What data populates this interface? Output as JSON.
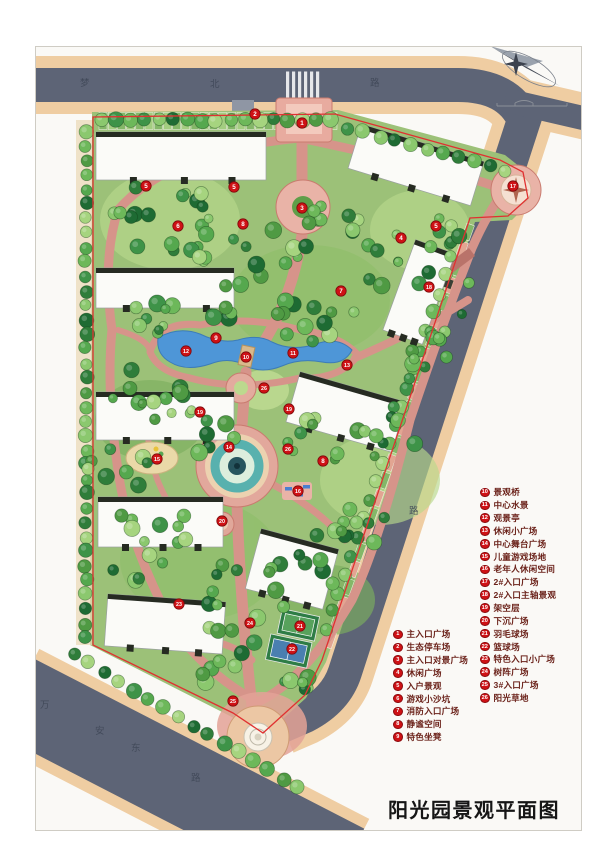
{
  "title": {
    "text": "阳光园景观平面图"
  },
  "legend": {
    "col1": [
      {
        "n": "1",
        "label": "主入口广场"
      },
      {
        "n": "2",
        "label": "生态停车场"
      },
      {
        "n": "3",
        "label": "主入口对景广场"
      },
      {
        "n": "4",
        "label": "休闲广场"
      },
      {
        "n": "5",
        "label": "入户景观"
      },
      {
        "n": "6",
        "label": "游戏小沙坑"
      },
      {
        "n": "7",
        "label": "消防入口广场"
      },
      {
        "n": "8",
        "label": "静谧空间"
      },
      {
        "n": "9",
        "label": "特色坐凳"
      }
    ],
    "col2": [
      {
        "n": "10",
        "label": "景观桥"
      },
      {
        "n": "11",
        "label": "中心水景"
      },
      {
        "n": "12",
        "label": "观景亭"
      },
      {
        "n": "13",
        "label": "休闲小广场"
      },
      {
        "n": "14",
        "label": "中心舞台广场"
      },
      {
        "n": "15",
        "label": "儿童游戏场地"
      },
      {
        "n": "16",
        "label": "老年人休闲空间"
      },
      {
        "n": "17",
        "label": "2#入口广场"
      },
      {
        "n": "18",
        "label": "2#入口主轴景观"
      },
      {
        "n": "19",
        "label": "架空层"
      },
      {
        "n": "20",
        "label": "下沉广场"
      },
      {
        "n": "21",
        "label": "羽毛球场"
      },
      {
        "n": "22",
        "label": "篮球场"
      },
      {
        "n": "23",
        "label": "特色入口小广场"
      },
      {
        "n": "24",
        "label": "树阵广场"
      },
      {
        "n": "25",
        "label": "3#入口广场"
      },
      {
        "n": "26",
        "label": "阳光草地"
      }
    ]
  },
  "roads": {
    "top": {
      "name": "梦北路",
      "chars": [
        {
          "ch": "梦",
          "x": 80,
          "y": 86
        },
        {
          "ch": "北",
          "x": 210,
          "y": 87
        },
        {
          "ch": "路",
          "x": 370,
          "y": 86
        }
      ]
    },
    "east": {
      "name": "路",
      "chars": [
        {
          "ch": "路",
          "x": 409,
          "y": 514
        }
      ]
    },
    "southwest": {
      "name": "万安东路",
      "chars": [
        {
          "ch": "万",
          "x": 40,
          "y": 708
        },
        {
          "ch": "安",
          "x": 95,
          "y": 734
        },
        {
          "ch": "东",
          "x": 131,
          "y": 751
        },
        {
          "ch": "路",
          "x": 191,
          "y": 781
        }
      ]
    }
  },
  "markers": [
    {
      "n": "1",
      "x": 302,
      "y": 123
    },
    {
      "n": "2",
      "x": 255,
      "y": 114
    },
    {
      "n": "3",
      "x": 302,
      "y": 208
    },
    {
      "n": "5",
      "x": 146,
      "y": 186
    },
    {
      "n": "5",
      "x": 234,
      "y": 187
    },
    {
      "n": "6",
      "x": 178,
      "y": 226
    },
    {
      "n": "8",
      "x": 243,
      "y": 224
    },
    {
      "n": "4",
      "x": 401,
      "y": 238
    },
    {
      "n": "5",
      "x": 436,
      "y": 226
    },
    {
      "n": "7",
      "x": 341,
      "y": 291
    },
    {
      "n": "9",
      "x": 216,
      "y": 338
    },
    {
      "n": "12",
      "x": 186,
      "y": 351
    },
    {
      "n": "10",
      "x": 246,
      "y": 357
    },
    {
      "n": "11",
      "x": 293,
      "y": 353
    },
    {
      "n": "13",
      "x": 347,
      "y": 365
    },
    {
      "n": "26",
      "x": 264,
      "y": 388
    },
    {
      "n": "19",
      "x": 289,
      "y": 409
    },
    {
      "n": "19",
      "x": 200,
      "y": 412
    },
    {
      "n": "14",
      "x": 229,
      "y": 447
    },
    {
      "n": "26",
      "x": 288,
      "y": 449
    },
    {
      "n": "15",
      "x": 157,
      "y": 459
    },
    {
      "n": "8",
      "x": 323,
      "y": 461
    },
    {
      "n": "16",
      "x": 298,
      "y": 491
    },
    {
      "n": "20",
      "x": 222,
      "y": 521
    },
    {
      "n": "17",
      "x": 513,
      "y": 186
    },
    {
      "n": "18",
      "x": 429,
      "y": 287
    },
    {
      "n": "23",
      "x": 179,
      "y": 604
    },
    {
      "n": "24",
      "x": 250,
      "y": 623
    },
    {
      "n": "21",
      "x": 300,
      "y": 626
    },
    {
      "n": "22",
      "x": 292,
      "y": 649
    },
    {
      "n": "25",
      "x": 233,
      "y": 701
    }
  ],
  "compass": {
    "icon": "north-arrow"
  },
  "scale_bar": {
    "icon": "scale-bar"
  },
  "colors": {
    "accent_red": "#cf1115",
    "boundary_red": "#e03131",
    "road_asphalt": "#5d6476",
    "sidewalk": "#efcda2",
    "site_green": "#9cc178",
    "water_blue": "#4e96d7",
    "path_pink": "#d6948a",
    "legend_text": "#6b221a"
  }
}
